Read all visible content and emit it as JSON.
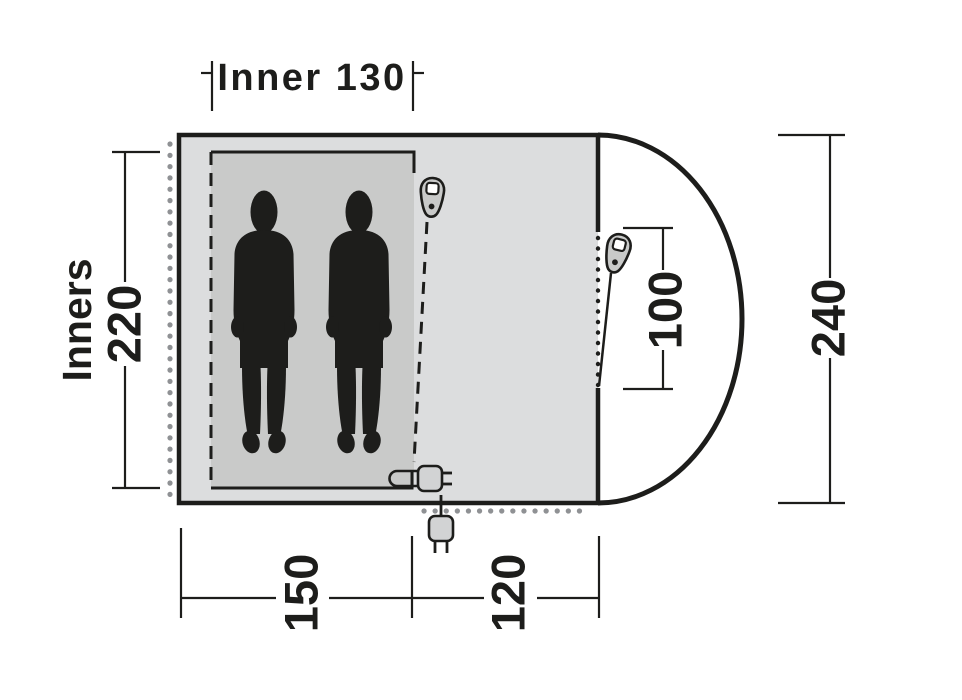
{
  "labels": {
    "inner_width": "Inner 130",
    "inners_title": "Inners",
    "inner_length": "220",
    "outer_length": "240",
    "door_height": "100",
    "inner_depth": "150",
    "porch_depth": "120"
  },
  "colors": {
    "line": "#1d1d1b",
    "tent_fill": "#dcddde",
    "inner_fill": "#c9cac9",
    "dots_gray": "#8f9194",
    "icon_fill": "#d2d3d4",
    "background": "#ffffff"
  },
  "icons": {
    "inner_zipper": "zipper-pull-icon",
    "front_zipper": "zipper-pull-icon",
    "inner_plug": "power-plug-icon",
    "outside_plug": "power-plug-icon"
  }
}
